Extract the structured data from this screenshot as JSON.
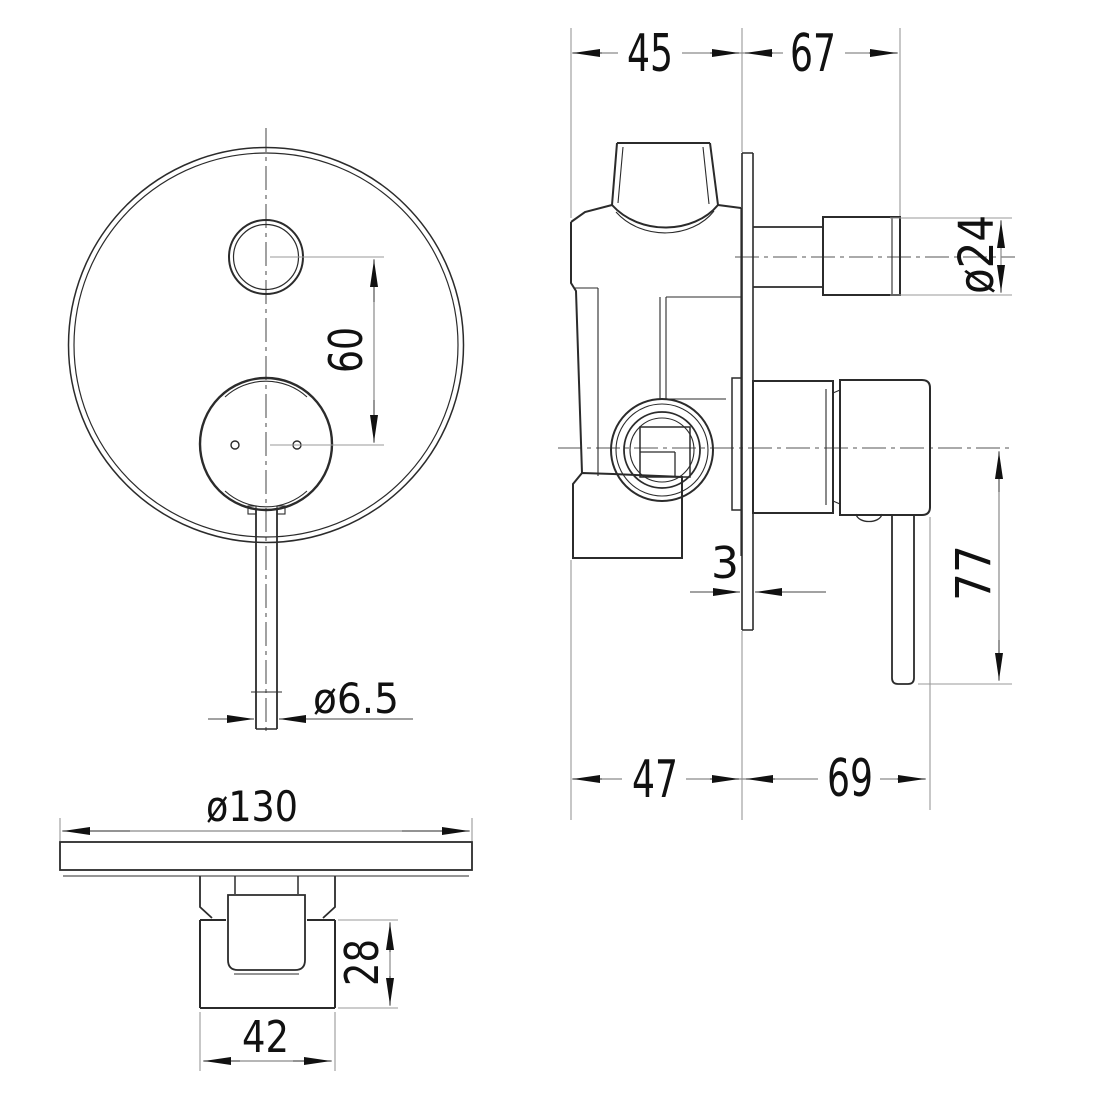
{
  "page": {
    "background": "#ffffff"
  },
  "drawing": {
    "type": "technical-dimension-drawing",
    "subject": "concealed shower mixer with diverter - front, side and bottom views",
    "colors": {
      "line": "#2b2b2b",
      "dimension_line": "#8a8a8a",
      "centerline": "#555555",
      "text": "#111111"
    },
    "dimensions": {
      "hole_spacing": "60",
      "lever_tip_diameter": "ø6.5",
      "plate_diameter": "ø130",
      "wall_depth": "45",
      "knob_projection": "67",
      "knob_diameter": "ø24",
      "plate_thickness": "3",
      "lever_length": "77",
      "body_depth": "47",
      "handle_projection": "69",
      "handle_height": "28",
      "handle_width": "42"
    }
  }
}
